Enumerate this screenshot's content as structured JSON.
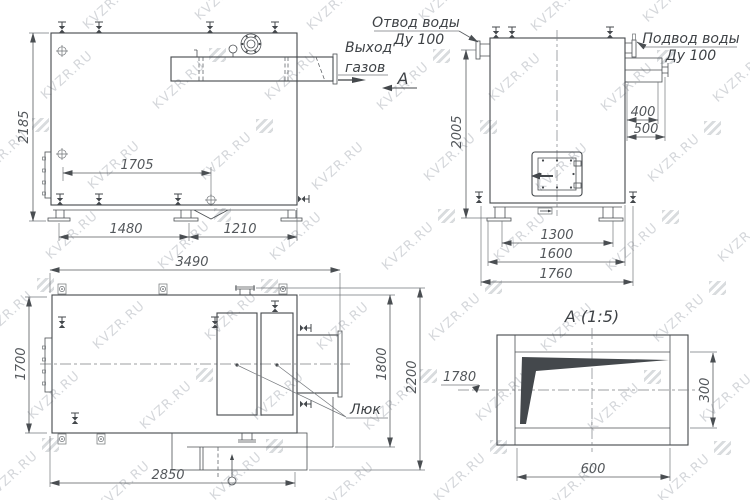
{
  "watermark": {
    "text": "KVZR.RU"
  },
  "front_view": {
    "dim_height": "2185",
    "dim_top": "1705",
    "dim_base_left": "1480",
    "dim_base_right": "1210",
    "label_gas_line1": "Выход",
    "label_gas_line2": "газов",
    "section_letter": "А"
  },
  "side_view": {
    "label_outlet_line1": "Отвод воды",
    "label_outlet_line2": "Ду 100",
    "label_inlet_line1": "Подвод воды",
    "label_inlet_line2": "Ду 100",
    "dim_height": "2005",
    "dim_duct": "400",
    "dim_duct_flange": "500",
    "dim_base_inner": "1300",
    "dim_base": "1600",
    "dim_overall": "1760"
  },
  "plan_view": {
    "dim_length": "3490",
    "dim_width": "1700",
    "dim_width_duct": "1800",
    "dim_width_overall": "2200",
    "dim_bottom": "2850",
    "label_hatch": "Люк"
  },
  "detail_view": {
    "title": "А (1:5)",
    "dim_width": "600",
    "dim_height": "300",
    "dim_level": "1780"
  }
}
